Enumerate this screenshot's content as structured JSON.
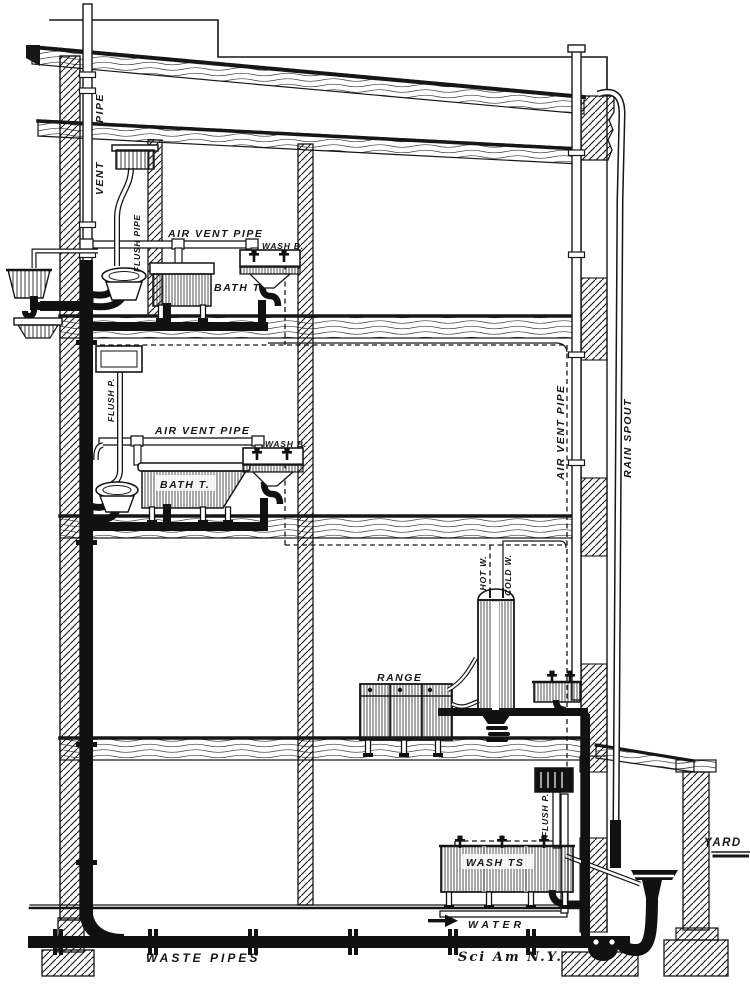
{
  "palette": {
    "ink": "#161616",
    "paper": "#ffffff"
  },
  "diagram": {
    "type": "plumbing-sectional-elevation",
    "labels": {
      "vent_pipe_word_top": "PIPE",
      "vent_pipe_word_bottom": "VENT",
      "flush_pipe_bath1": "FLUSH PIPE",
      "air_vent_bath1": "AIR VENT PIPE",
      "wash_basin_1": "WASH B.",
      "bath_tub_1": "BATH T.",
      "flush_pipe_bath2": "FLUSH P.",
      "air_vent_bath2": "AIR VENT PIPE",
      "wash_basin_2": "WASH B.",
      "bath_tub_2": "BATH T.",
      "air_vent_stack": "AIR VENT PIPE",
      "rain_spout": "RAIN SPOUT",
      "hot_water": "HOT W.",
      "cold_water": "COLD W.",
      "range": "RANGE",
      "flush_pipe_laundry": "FLUSH P.",
      "wash_tubs": "WASH TS",
      "water_main": "WATER",
      "waste_pipes": "WASTE PIPES",
      "yard": "YARD",
      "credit": "Sci Am N.Y."
    }
  }
}
